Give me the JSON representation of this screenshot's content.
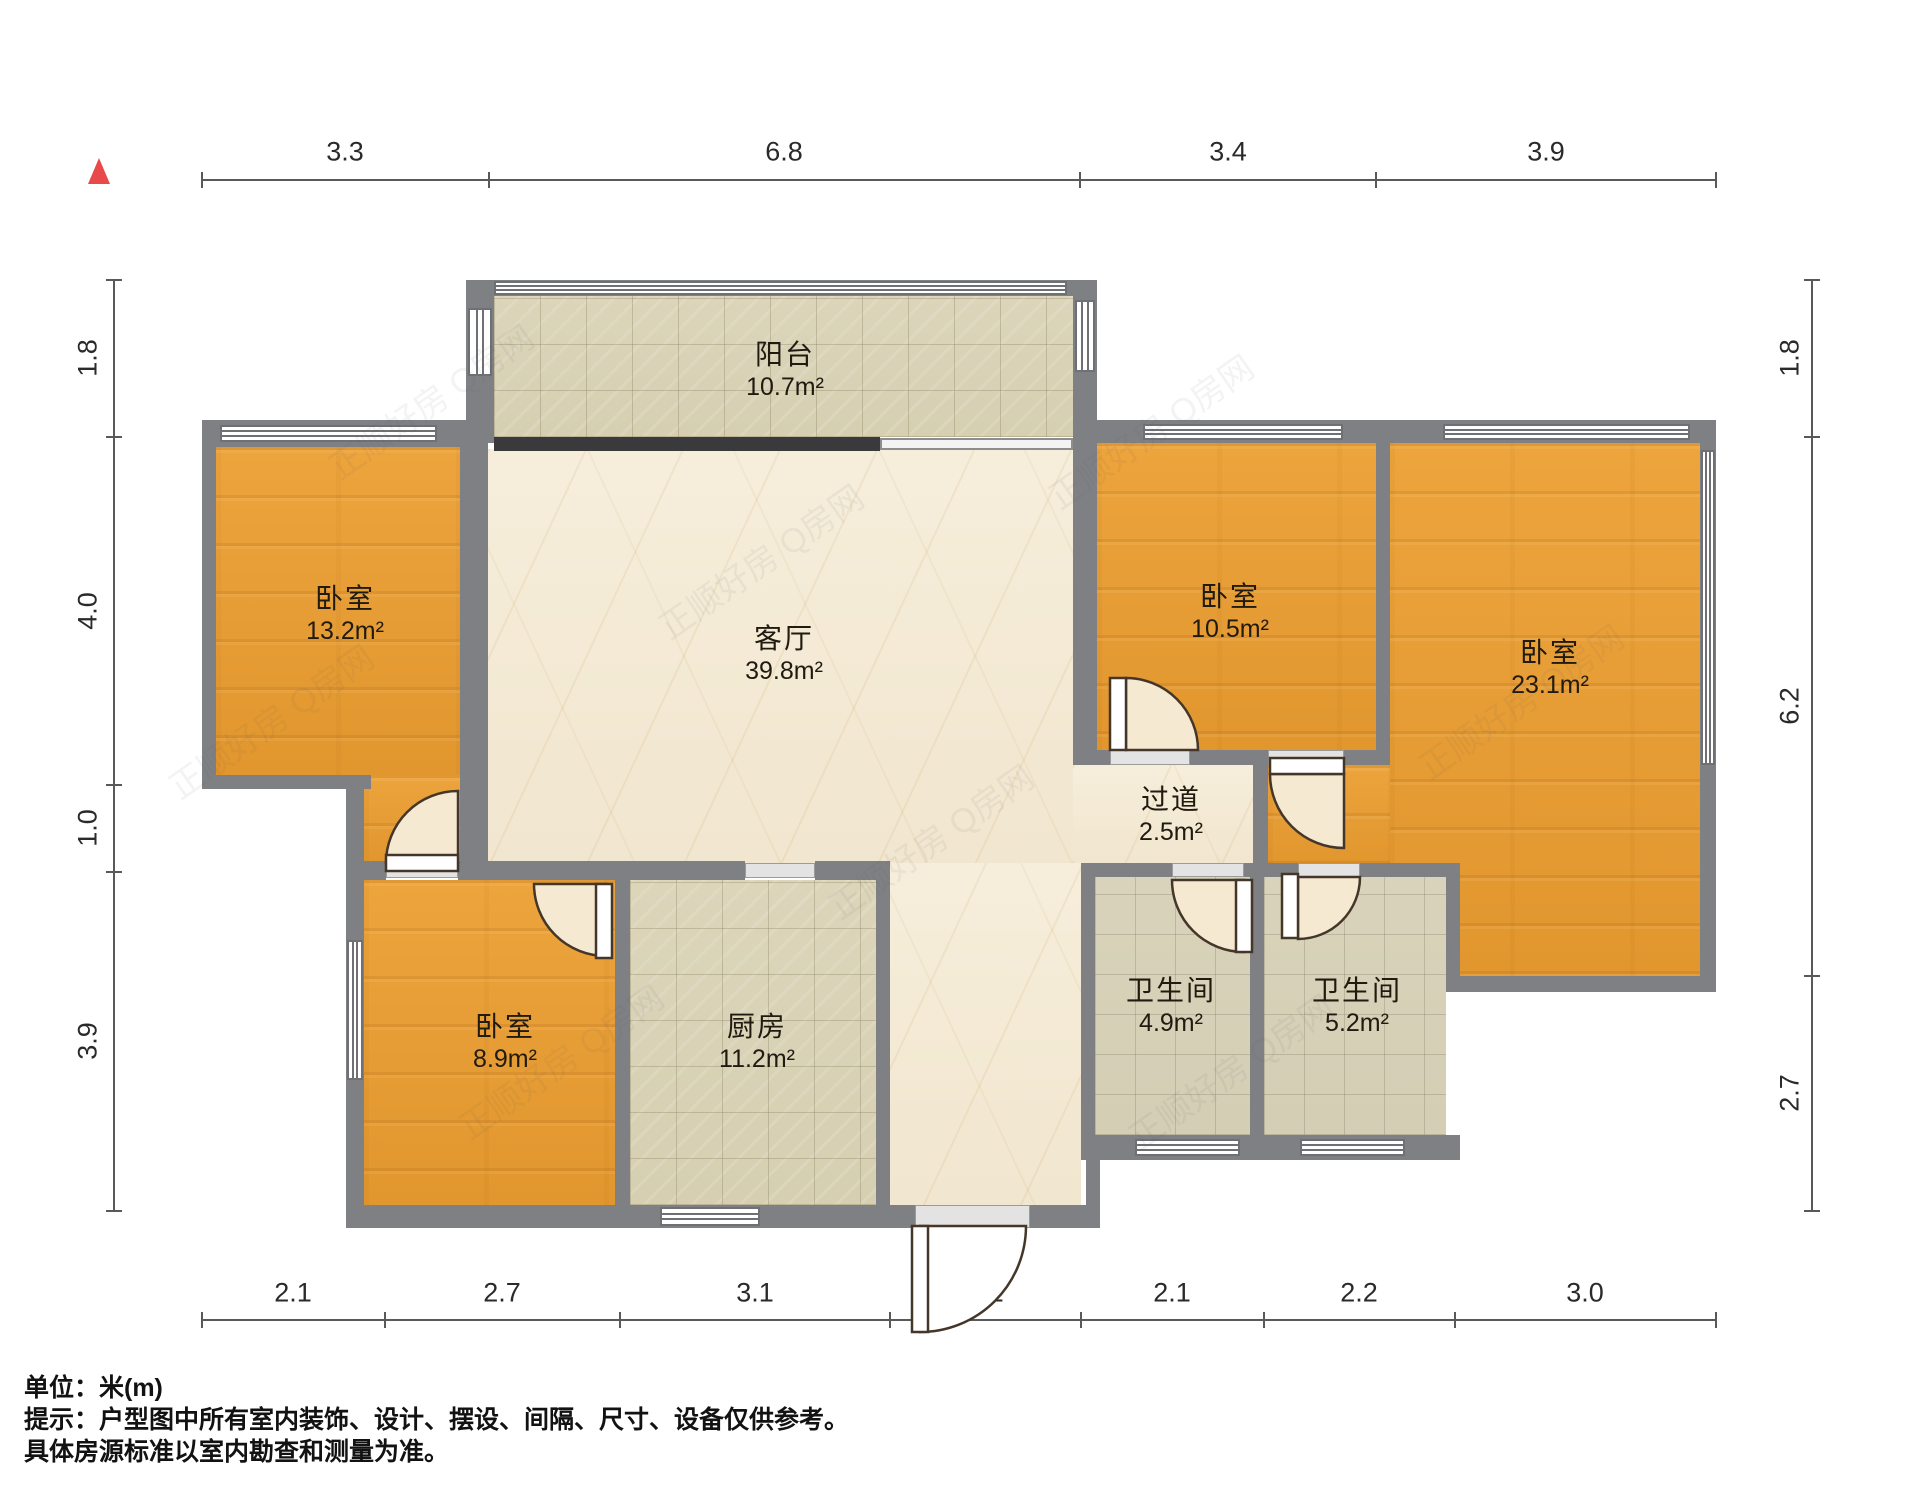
{
  "plan": {
    "unit_scale_note": "米(m)",
    "north_marker_color": "#e8494a"
  },
  "rooms": [
    {
      "id": "balcony",
      "name": "阳台",
      "area": "10.7m²"
    },
    {
      "id": "bedroom-left",
      "name": "卧室",
      "area": "13.2m²"
    },
    {
      "id": "living-room",
      "name": "客厅",
      "area": "39.8m²"
    },
    {
      "id": "bedroom-mid",
      "name": "卧室",
      "area": "10.5m²"
    },
    {
      "id": "bedroom-right",
      "name": "卧室",
      "area": "23.1m²"
    },
    {
      "id": "hallway",
      "name": "过道",
      "area": "2.5m²"
    },
    {
      "id": "bedroom-bottom",
      "name": "卧室",
      "area": "8.9m²"
    },
    {
      "id": "kitchen",
      "name": "厨房",
      "area": "11.2m²"
    },
    {
      "id": "bathroom-1",
      "name": "卫生间",
      "area": "4.9m²"
    },
    {
      "id": "bathroom-2",
      "name": "卫生间",
      "area": "5.2m²"
    }
  ],
  "dimensions": {
    "top": [
      "3.3",
      "6.8",
      "3.4",
      "3.9"
    ],
    "bottom": [
      "2.1",
      "2.7",
      "3.1",
      "2.2",
      "2.1",
      "2.2",
      "3.0"
    ],
    "left": [
      "1.8",
      "4.0",
      "1.0",
      "3.9"
    ],
    "right": [
      "1.8",
      "6.2",
      "2.7"
    ]
  },
  "watermark": "正顺好房 Q房网",
  "footer": {
    "line1": "单位：米(m)",
    "line2": "提示：户型图中所有室内装饰、设计、摆设、间隔、尺寸、设备仅供参考。",
    "line3": "具体房源标准以室内勘查和测量为准。"
  },
  "colors": {
    "wall": "#7e8083",
    "wood_floor": "#e8a23c",
    "marble_floor": "#f4ecd8",
    "tile_floor": "#d9d3b7",
    "north_red": "#e8494a"
  }
}
